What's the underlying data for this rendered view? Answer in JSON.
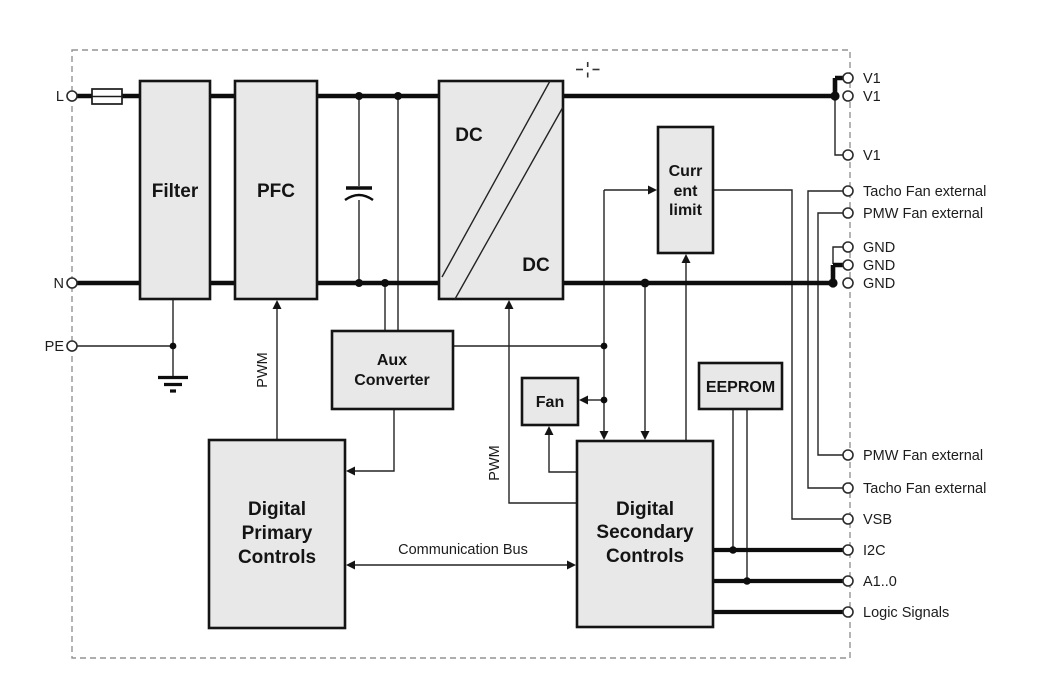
{
  "colors": {
    "background": "#ffffff",
    "block_fill": "#e8e8e8",
    "block_border": "#141414",
    "wire": "#0d0d0d",
    "frame_dash": "#949494"
  },
  "blocks": {
    "filter": {
      "label": "Filter"
    },
    "pfc": {
      "label": "PFC"
    },
    "dcdc": {
      "label_input": "DC",
      "label_output": "DC"
    },
    "current_limit": {
      "line1": "Curr",
      "line2": "ent",
      "line3": "limit"
    },
    "aux_converter": {
      "line1": "Aux",
      "line2": "Converter"
    },
    "fan": {
      "label": "Fan"
    },
    "eeprom": {
      "label": "EEPROM"
    },
    "digital_primary": {
      "line1": "Digital",
      "line2": "Primary",
      "line3": "Controls"
    },
    "digital_secondary": {
      "line1": "Digital",
      "line2": "Secondary",
      "line3": "Controls"
    }
  },
  "wire_labels": {
    "pwm_primary": "PWM",
    "pwm_secondary": "PWM",
    "communication_bus": "Communication Bus"
  },
  "input_terminals": [
    {
      "label": "L"
    },
    {
      "label": "N"
    },
    {
      "label": "PE"
    }
  ],
  "output_terminals": [
    {
      "label": "V1"
    },
    {
      "label": "V1"
    },
    {
      "label": "V1"
    },
    {
      "label": "Tacho Fan external"
    },
    {
      "label": "PMW Fan external"
    },
    {
      "label": "GND"
    },
    {
      "label": "GND"
    },
    {
      "label": "GND"
    },
    {
      "label": "PMW Fan external"
    },
    {
      "label": "Tacho Fan external"
    },
    {
      "label": "VSB"
    },
    {
      "label": "I2C"
    },
    {
      "label": "A1..0"
    },
    {
      "label": "Logic Signals"
    }
  ]
}
